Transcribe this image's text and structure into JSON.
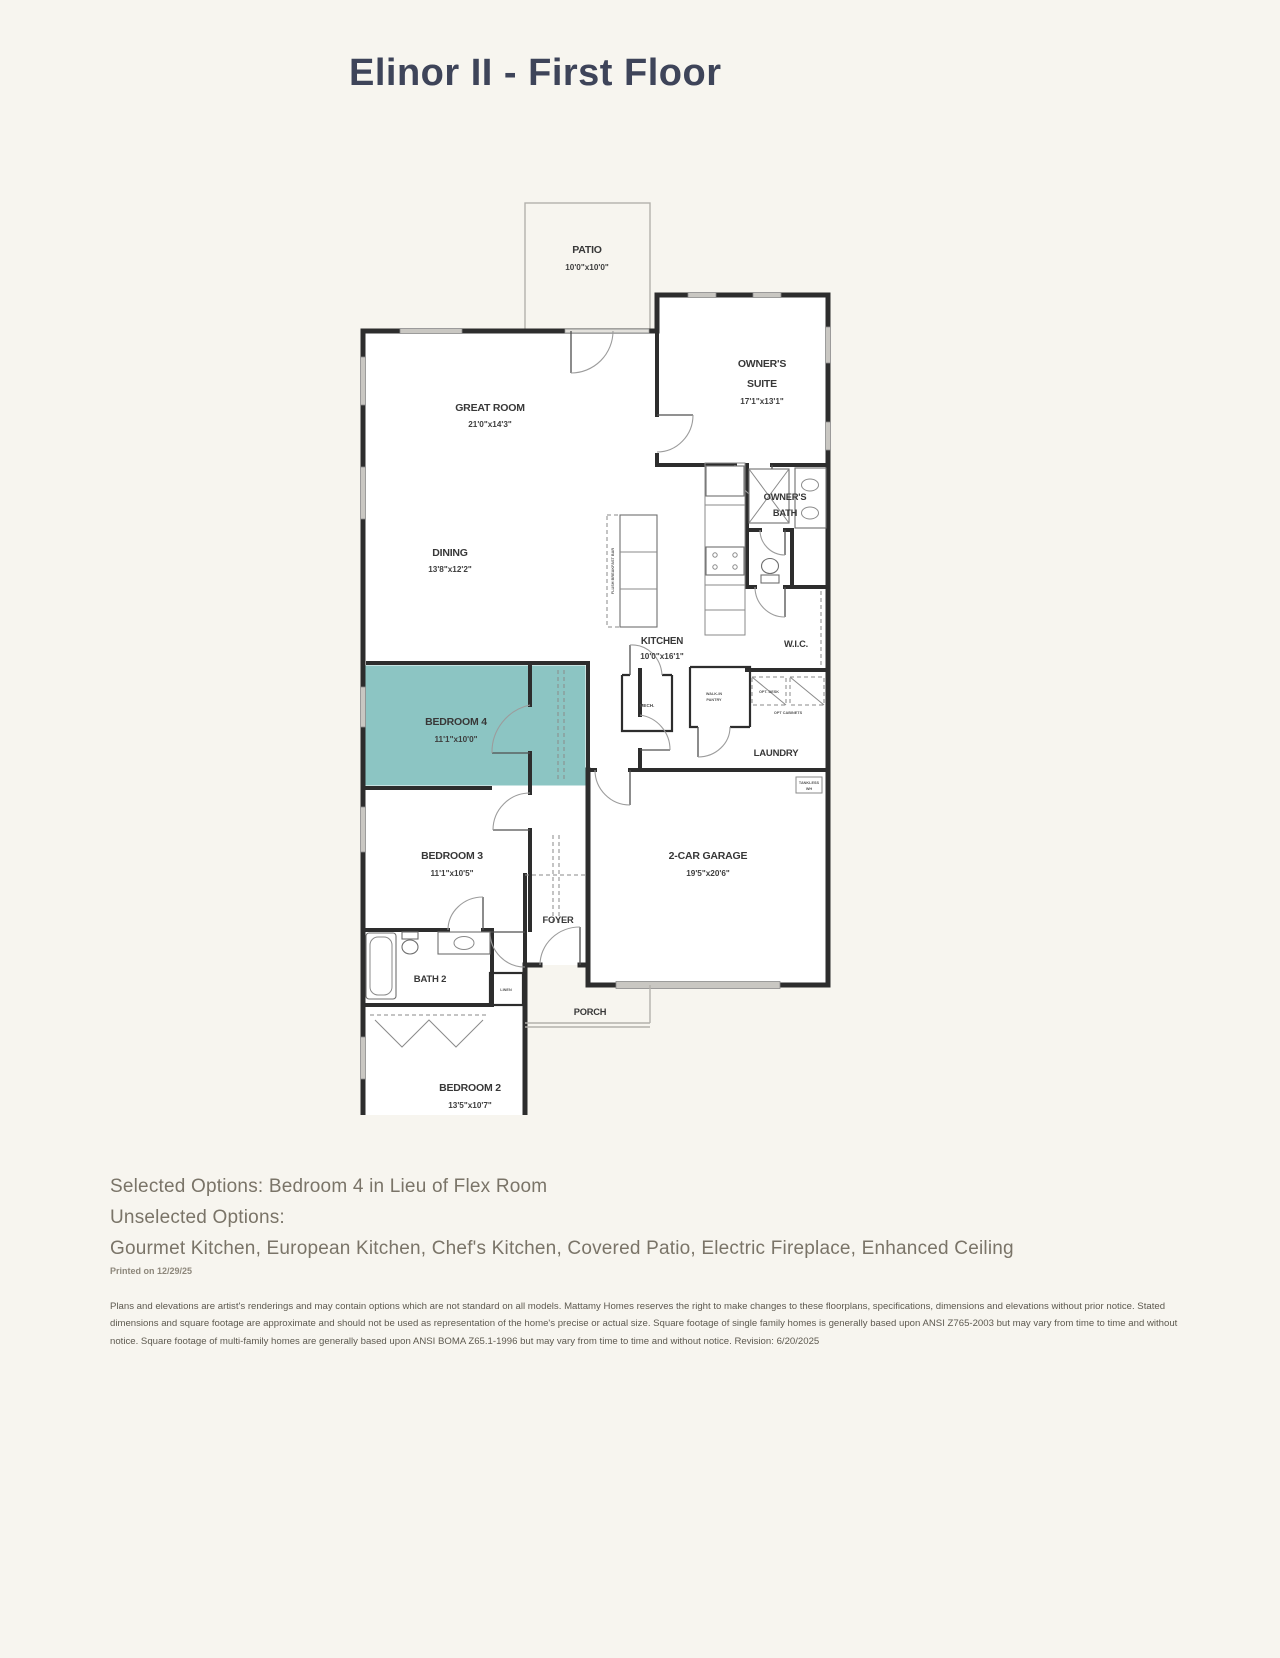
{
  "page": {
    "title": "Elinor II - First Floor",
    "colors": {
      "background": "#f7f5ef",
      "title": "#3e4459",
      "wall": "#2d2d2d",
      "highlight": "#8cc5c3",
      "window": "#c9c7c2"
    }
  },
  "rooms": {
    "patio": {
      "label": "PATIO",
      "dims": "10'0\"x10'0\""
    },
    "great_room": {
      "label": "GREAT ROOM",
      "dims": "21'0\"x14'3\""
    },
    "owners_suite": {
      "label_line1": "OWNER'S",
      "label_line2": "SUITE",
      "dims": "17'1\"x13'1\""
    },
    "owners_bath": {
      "label_line1": "OWNER'S",
      "label_line2": "BATH"
    },
    "dining": {
      "label": "DINING",
      "dims": "13'8\"x12'2\""
    },
    "kitchen": {
      "label": "KITCHEN",
      "dims": "10'0\"x16'1\""
    },
    "wic": {
      "label": "W.I.C."
    },
    "bedroom4": {
      "label": "BEDROOM 4",
      "dims": "11'1\"x10'0\""
    },
    "laundry": {
      "label": "LAUNDRY"
    },
    "bedroom3": {
      "label": "BEDROOM 3",
      "dims": "11'1\"x10'5\""
    },
    "garage": {
      "label": "2-CAR GARAGE",
      "dims": "19'5\"x20'6\""
    },
    "foyer": {
      "label": "FOYER"
    },
    "bath2": {
      "label": "BATH 2"
    },
    "porch": {
      "label": "PORCH"
    },
    "bedroom2": {
      "label": "BEDROOM 2",
      "dims": "13'5\"x10'7\""
    }
  },
  "annotations": {
    "breakfast_bar": "FLUSH BREAKFAST BAR",
    "mech": "MECH.",
    "pantry_line1": "WALK-IN",
    "pantry_line2": "PANTRY",
    "linen": "LINEN",
    "opt_desk": "OPT. DESK",
    "opt_cabinets": "OPT CABINETS",
    "tankless_line1": "TANKLESS",
    "tankless_line2": "WH"
  },
  "footer": {
    "selected_options": "Selected Options: Bedroom 4 in Lieu of Flex Room",
    "unselected_heading": "Unselected Options:",
    "unselected_options": "Gourmet Kitchen, European Kitchen, Chef's Kitchen, Covered Patio, Electric Fireplace, Enhanced Ceiling",
    "printed": "Printed on 12/29/25",
    "disclaimer": "Plans and elevations are artist's renderings and may contain options which are not standard on all models. Mattamy Homes reserves the right to make changes to these floorplans, specifications, dimensions and elevations without prior notice. Stated dimensions and square footage are approximate and should not be used as representation of the home's precise or actual size. Square footage of single family homes is generally based upon ANSI Z765-2003 but may vary from time to time and without notice. Square footage of multi-family homes are generally based upon ANSI BOMA Z65.1-1996 but may vary from time to time and without notice. Revision: 6/20/2025"
  }
}
